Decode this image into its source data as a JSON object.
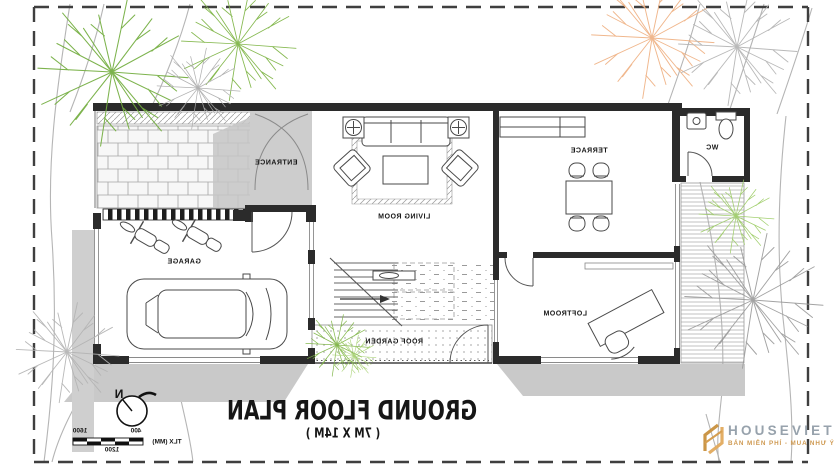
{
  "plan": {
    "title": "GROUND FLOOR PLAN",
    "subtitle": "( 7M X 14M )",
    "text_mirrored": true,
    "rooms": {
      "entrance": "ENTRANCE",
      "living_room": "LIVING ROOM",
      "terrace": "TERRACE",
      "wc": "WC",
      "garage": "GARAGE",
      "loftroom": "LOFTROOM",
      "roof_garden": "ROOF GARDEN"
    },
    "compass_north": "N",
    "scale_bar": {
      "tick_1600": "1600",
      "tick_400": "400",
      "tick_1200": "1200",
      "unit": "TLX (MM)"
    },
    "colors": {
      "wall": "#2b2b2b",
      "shadow": "#c9c9c9",
      "entrance_fill": "#cdcdcd",
      "boundary": "#3f3f3f",
      "tree_green": "#7cb342",
      "tree_gray": "#ababab",
      "tree_orange": "#efb183"
    }
  },
  "watermark": {
    "brand": "HOUSEVIET",
    "tagline": "BẢN MIỄN PHÍ - MUA NHƯ Ý",
    "brand_color": "#97a2ac",
    "accent_color": "#cf9a52"
  }
}
